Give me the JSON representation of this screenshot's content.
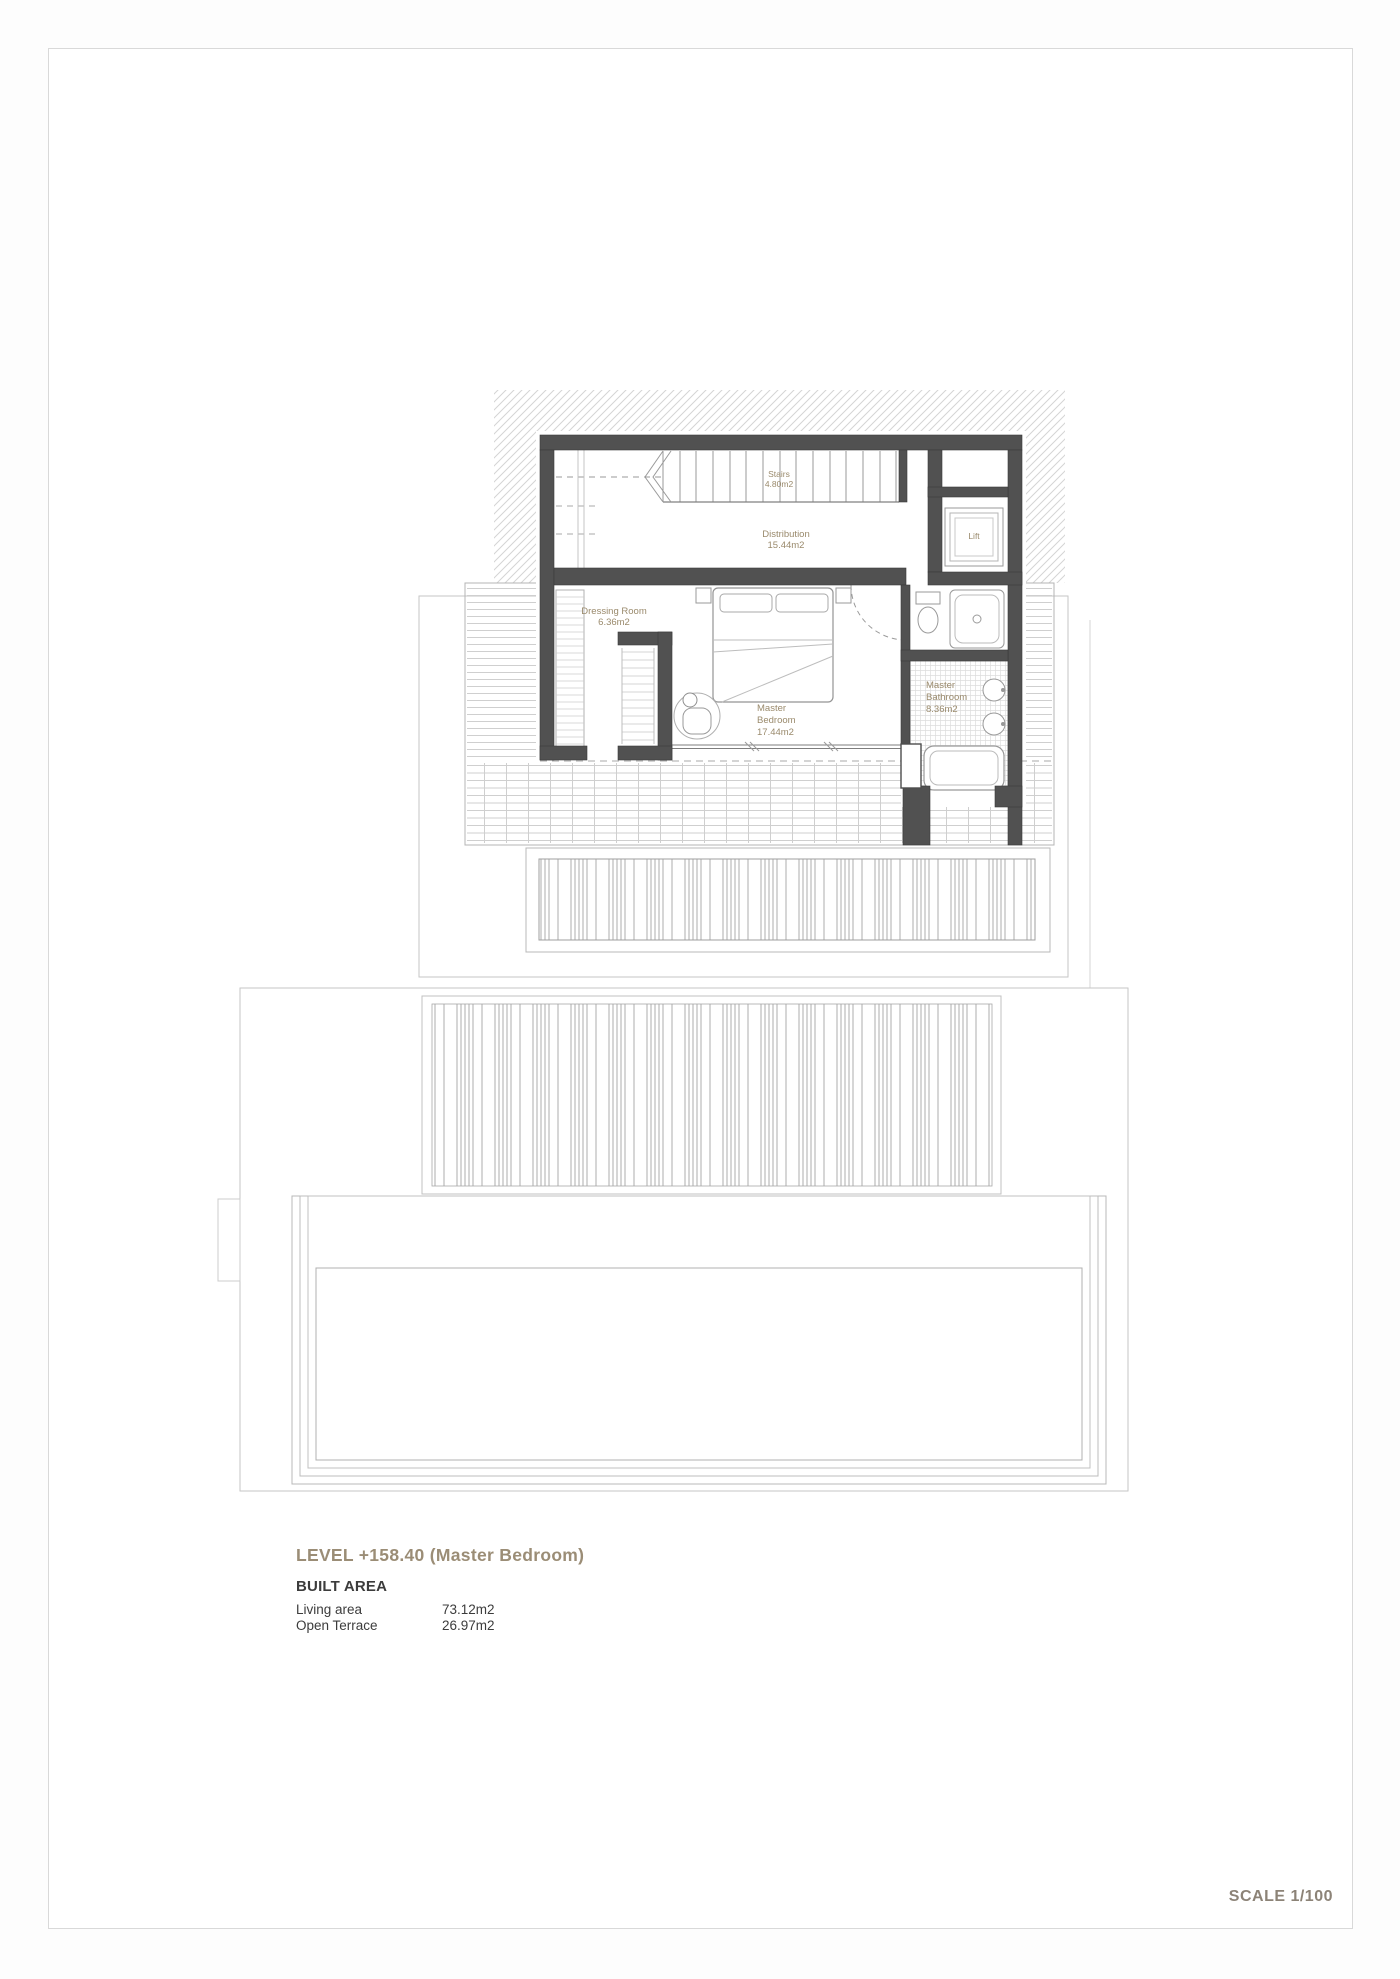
{
  "page": {
    "scale_label": "SCALE 1/100"
  },
  "colors": {
    "wall": "#515151",
    "accent_text": "#9b8d76",
    "room_label": "#9a8a6c",
    "dark_text": "#3c3c3c"
  },
  "plan": {
    "rooms": {
      "stairs": {
        "label": "Stairs\n4.80m2"
      },
      "distribution": {
        "label": "Distribution\n15.44m2"
      },
      "dressing_room": {
        "label": "Dressing Room\n6.36m2"
      },
      "master_bedroom": {
        "label": "Master\nBedroom\n17.44m2"
      },
      "master_bathroom": {
        "label": "Master\nBathroom\n8.36m2"
      },
      "lift": {
        "label": "Lift"
      }
    }
  },
  "footer": {
    "level_title": "LEVEL +158.40 (Master Bedroom)",
    "built_area_heading": "BUILT AREA",
    "rows": [
      {
        "label": "Living area",
        "value": "73.12m2"
      },
      {
        "label": "Open Terrace",
        "value": "26.97m2"
      }
    ]
  }
}
